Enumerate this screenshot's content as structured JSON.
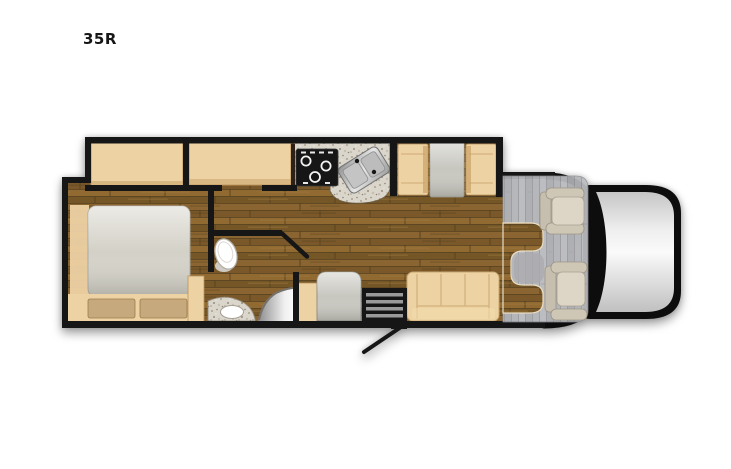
{
  "page": {
    "background": "#ffffff"
  },
  "floorplan": {
    "model_label": "35R",
    "colors": {
      "wall": "#141414",
      "wood_floor_base": "#7e5d2d",
      "furniture_tan": "#edd2a4",
      "drawer_tan": "#c6a97b",
      "mattress_gray": "#d3d1c7",
      "table_gray": "#c7c6bf",
      "counter_speckle_base": "#dad6cc",
      "appliance_black": "#141414",
      "step_stripe_gray": "#9a9a9a",
      "cab_floor_gray": "#b5b6ba",
      "seat_beige": "#ddd6c6",
      "hood_light_gray": "#ededed",
      "fixture_white": "#ffffff"
    }
  }
}
